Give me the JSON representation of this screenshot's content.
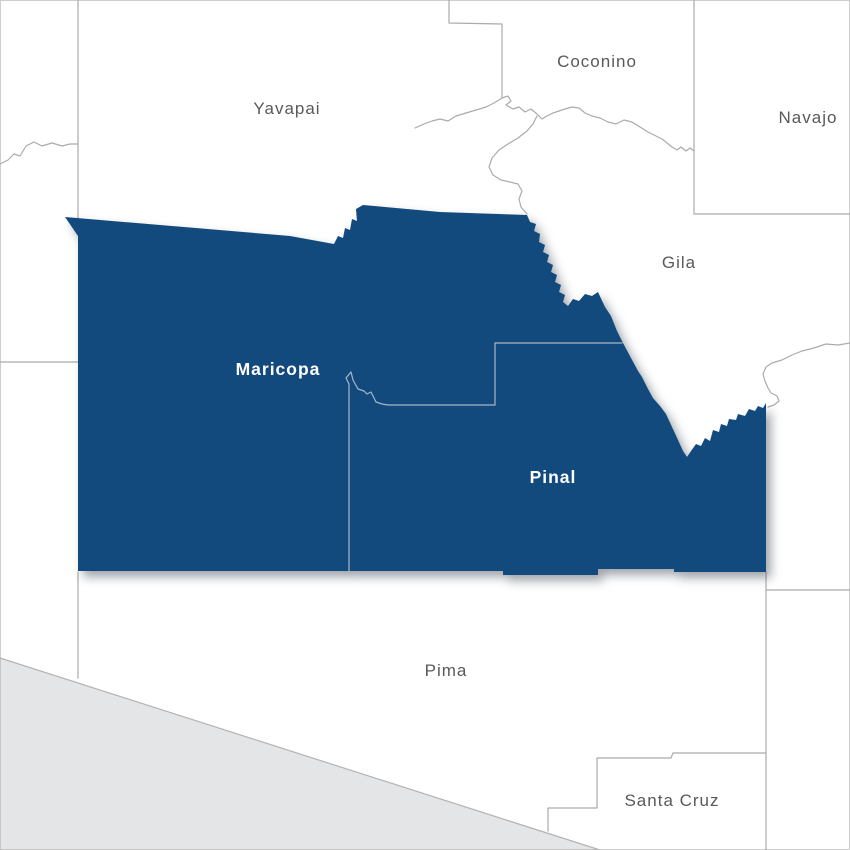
{
  "map": {
    "title": "Arizona counties map with Maricopa and Pinal highlighted",
    "colors": {
      "background": "#ffffff",
      "frame": "#cdcdcd",
      "county_line": "#ababab",
      "inner_boundary_line": "#a7b6c6",
      "highlight_fill": "#134a7d",
      "outside_area_fill": "#e4e5e6",
      "outside_area_border": "#b3b3b3",
      "label_gray": "#58595b",
      "label_white": "#ffffff",
      "shadow": "rgba(45,55,70,0.45)"
    },
    "outside_area": {
      "name": "mexico-area",
      "path": "M0,658 L600,850 L0,850 Z"
    },
    "highlight_region": {
      "name": "maricopa-pinal-highlight",
      "path": "M65,217 L290,236 L334,244 L338,236 L343,238 L345,228 L350,230 L352,219 L357,221 L356,209 L363,205 L440,212 L527,215 L530,222 L536,224 L534,231 L540,234 L539,242 L545,245 L543,252 L549,255 L547,262 L553,265 L551,272 L557,275 L555,282 L561,285 L559,292 L565,295 L563,302 L568,306 L573,299 L579,301 L585,294 L592,296 L598,292 L605,307 L611,316 L617,331 L623,343 L631,358 L638,371 L642,377 L648,389 L653,398 L660,406 L666,414 L672,427 L678,440 L683,451 L687,457 L691,451 L696,444 L701,446 L705,438 L710,441 L713,430 L719,432 L721,424 L727,426 L729,419 L736,420 L738,414 L745,416 L749,409 L755,411 L758,406 L763,408 L766,403 L766,572 L674,572 L674,569 L598,569 L598,575 L503,575 L503,571 L349,571 L78,571 L78,236 Z"
    },
    "inner_boundary": {
      "name": "maricopa-pinal-boundary",
      "path": "M349,571 L349,384 L346,378 L351,372 L353,380 L358,389 L364,391 L367,394 L371,392 L374,398 L376,402 L382,404 L388,405 L495,405 L495,343 L622,343"
    },
    "county_lines": [
      {
        "name": "lapaz-yavapai-line",
        "path": "M78,0 L78,218"
      },
      {
        "name": "mohave-lapaz-river",
        "path": "M0,164 L8,160 L14,154 L20,156 L26,146 L34,142 L42,146 L52,143 L62,146 L70,144 L78,144"
      },
      {
        "name": "lapaz-yuma-line",
        "path": "M0,362 L78,362"
      },
      {
        "name": "yuma-pima-line",
        "path": "M78,572 L78,678"
      },
      {
        "name": "coconino-west-line",
        "path": "M449,0 L449,23 L502,24 L502,98"
      },
      {
        "name": "mogollon-rim-line",
        "path": "M415,128 L424,124 L432,121 L440,119 L448,121 L456,116 L466,113 L476,110 L486,107 L494,103 L502,98 L508,96 L511,101 L506,105 L513,109 L519,107 L525,112 L531,109 L537,114 L542,119 L547,116 L553,113 L559,111 L565,109 L572,107 L579,108 L585,113 L592,116 L600,118 L608,122 L616,124 L624,120 L632,122 L640,127 L648,132 L656,136 L662,139 L667,143 L672,147 L677,150 L681,147 L686,151 L690,148 L694,151"
      },
      {
        "name": "verde-river-line",
        "path": "M537,116 L533,124 L527,131 L518,138 L508,144 L499,150 L492,158 L489,167 L493,175 L501,180 L510,182 L518,184 L522,191 L519,199 L521,207 L527,214"
      },
      {
        "name": "navajo-west-line",
        "path": "M694,0 L694,214"
      },
      {
        "name": "navajo-south-line",
        "path": "M694,214 L850,214"
      },
      {
        "name": "gila-graham-line",
        "path": "M850,343 L838,345 L826,344 L814,348 L802,351 L792,355 L782,360 L772,363 L766,367 L763,374 L765,381 L768,388 L771,393 L777,396 L779,401 L774,405 L768,407"
      },
      {
        "name": "cochise-west-line",
        "path": "M766,572 L766,850"
      },
      {
        "name": "graham-cochise-line",
        "path": "M766,590 L850,590"
      },
      {
        "name": "santacruz-west-line",
        "path": "M597,758 L597,808 L548,808 L548,831"
      },
      {
        "name": "santacruz-north-line",
        "path": "M597,758 L671,758 L673,753 L766,753"
      }
    ],
    "labels": [
      {
        "name": "county-label-yavapai",
        "text": "Yavapai",
        "x": 287,
        "y": 114,
        "style": "plain",
        "size": 17
      },
      {
        "name": "county-label-coconino",
        "text": "Coconino",
        "x": 597,
        "y": 67,
        "style": "plain",
        "size": 17
      },
      {
        "name": "county-label-navajo",
        "text": "Navajo",
        "x": 808,
        "y": 123,
        "style": "plain",
        "size": 17
      },
      {
        "name": "county-label-gila",
        "text": "Gila",
        "x": 679,
        "y": 268,
        "style": "plain",
        "size": 17
      },
      {
        "name": "county-label-pima",
        "text": "Pima",
        "x": 446,
        "y": 676,
        "style": "plain",
        "size": 17
      },
      {
        "name": "county-label-santa-cruz",
        "text": "Santa Cruz",
        "x": 672,
        "y": 806,
        "style": "plain",
        "size": 17
      },
      {
        "name": "county-label-maricopa",
        "text": "Maricopa",
        "x": 278,
        "y": 375,
        "style": "highlight",
        "size": 17.5
      },
      {
        "name": "county-label-pinal",
        "text": "Pinal",
        "x": 553,
        "y": 483,
        "style": "highlight",
        "size": 17.5
      }
    ]
  }
}
